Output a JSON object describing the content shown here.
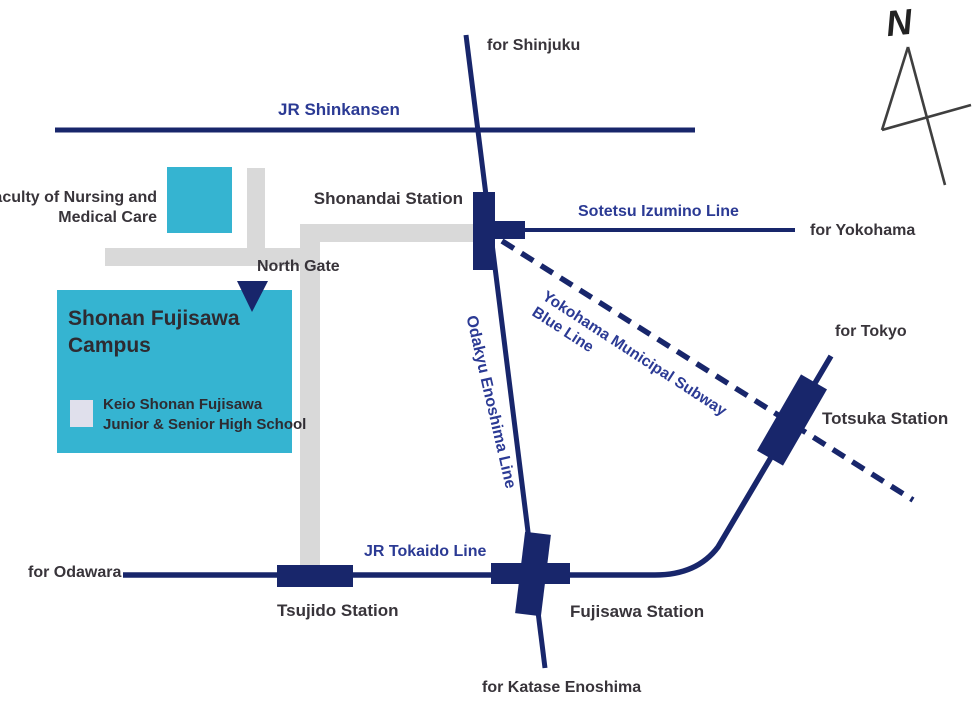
{
  "colors": {
    "navy": "#18266b",
    "blue": "#2b3a94",
    "teal": "#35b4d1",
    "road": "#d9d9d9",
    "dark": "#38343a",
    "keio": "#e0e0ec"
  },
  "compass": {
    "label": "N"
  },
  "lines": {
    "shinkansen": "JR Shinkansen",
    "sotetsu": "Sotetsu Izumino Line",
    "subway_line1": "Yokohama Municipal  Subway",
    "subway_line2": "Blue Line",
    "odakyu": "Odakyu Enoshima Line",
    "tokaido": "JR Tokaido Line"
  },
  "stations": {
    "shonandai": "Shonandai Station",
    "totsuka": "Totsuka Station",
    "tsujido": "Tsujido Station",
    "fujisawa": "Fujisawa Station"
  },
  "destinations": {
    "shinjuku": "for Shinjuku",
    "yokohama": "for Yokohama",
    "tokyo": "for Tokyo",
    "odawara": "for Odawara",
    "katase": "for Katase Enoshima"
  },
  "places": {
    "faculty_line1": "Faculty of Nursing and",
    "faculty_line2": "Medical Care",
    "north_gate": "North Gate",
    "campus_line1": "Shonan Fujisawa",
    "campus_line2": "Campus",
    "keio_line1": "Keio Shonan Fujisawa",
    "keio_line2": "Junior &amp; Senior High School"
  }
}
